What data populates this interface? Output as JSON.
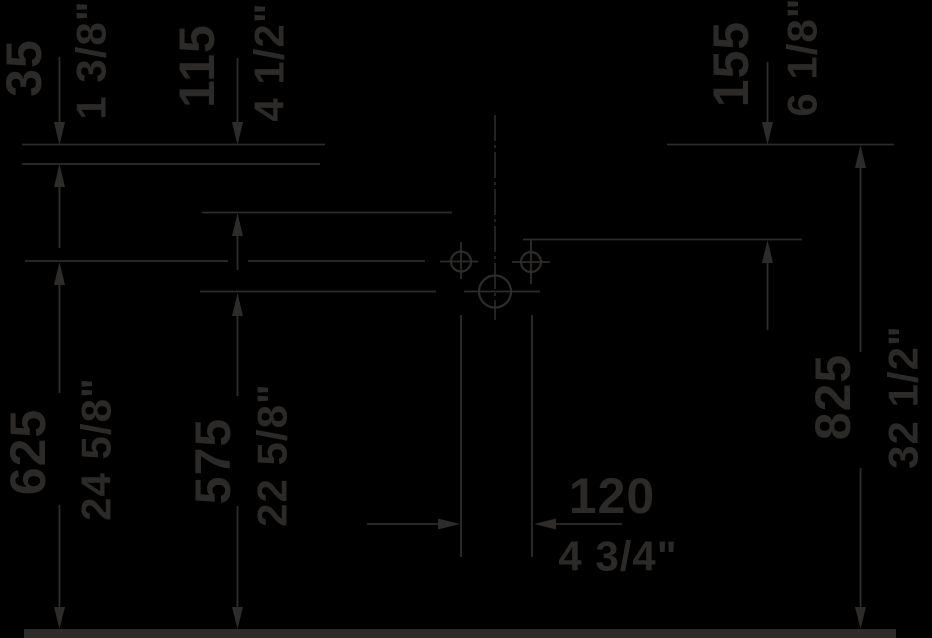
{
  "drawing": {
    "title": "washbasin-installation-dimensions",
    "colors": {
      "background": "#000000",
      "line": "#2e2c2a",
      "text": "#2b2a28"
    },
    "dimensions": {
      "d35": {
        "mm": "35",
        "inch": "1 3/8\""
      },
      "d115": {
        "mm": "115",
        "inch": "4 1/2\""
      },
      "d155": {
        "mm": "155",
        "inch": "6 1/8\""
      },
      "d625": {
        "mm": "625",
        "inch": "24 5/8\""
      },
      "d575": {
        "mm": "575",
        "inch": "22 5/8\""
      },
      "d825": {
        "mm": "825",
        "inch": "32 1/2\""
      },
      "d120": {
        "mm": "120",
        "inch": "4 3/4\""
      }
    }
  }
}
